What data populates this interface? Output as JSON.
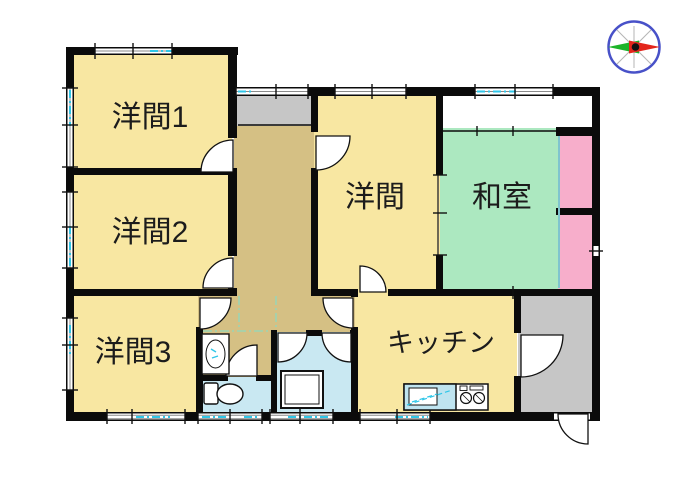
{
  "rooms": {
    "yoma1": {
      "label": "洋間1",
      "fill": "#F8E7A2"
    },
    "yoma2": {
      "label": "洋間2",
      "fill": "#F8E7A2"
    },
    "yoma3": {
      "label": "洋間3",
      "fill": "#F8E7A2"
    },
    "yoma": {
      "label": "洋間",
      "fill": "#F8E7A2"
    },
    "washitsu": {
      "label": "和室",
      "fill": "#ACE8C0"
    },
    "kitchen": {
      "label": "キッチン",
      "fill": "#F8E7A2"
    },
    "hallway": {
      "fill": "#D5C084"
    },
    "bathroom": {
      "fill": "#C9E8F2"
    },
    "toilet": {
      "fill": "#C9E8F2"
    },
    "entry": {
      "fill": "#C6C6C6"
    },
    "storage_top": {
      "fill": "#C6C6C6"
    },
    "closet_upper": {
      "fill": "#F7AECB"
    },
    "closet_lower": {
      "fill": "#F7AECB"
    }
  },
  "palette": {
    "wall": "#0b0b0b",
    "window_glass": "#2FC6E8",
    "guide_line": "#8FD9BE",
    "fusuma_line": "#7FC4CE",
    "counter_top": "#BFE4F0",
    "label_color": "#1c1c1c"
  },
  "compass": {
    "ring": "#4851C8",
    "east_needle": "#E3251B",
    "west_needle": "#1DB42A",
    "pivot": "#111111",
    "cross": "#B5B5B5"
  }
}
